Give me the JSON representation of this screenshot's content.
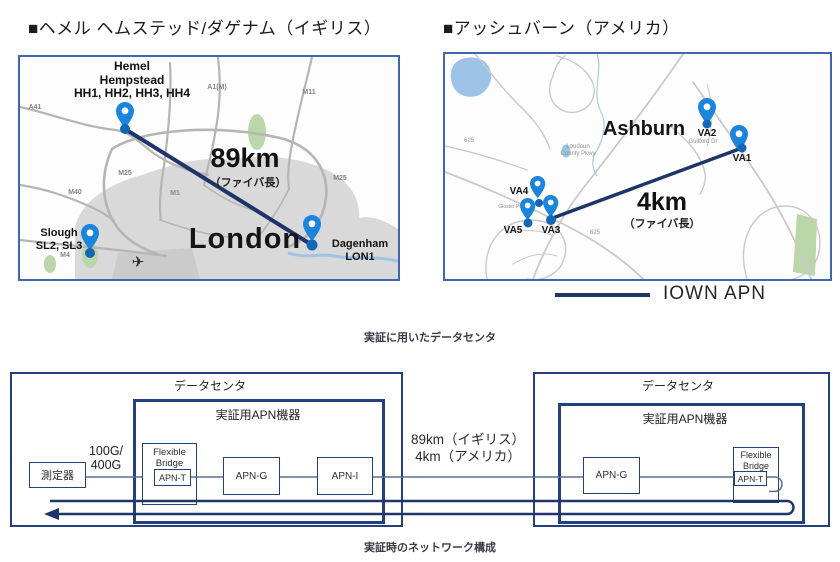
{
  "uk": {
    "title": "■ヘメル ヘムステッド/ダゲナム（イギリス）",
    "hemel": [
      "Hemel",
      "Hempstead",
      "HH1, HH2, HH3, HH4"
    ],
    "slough": [
      "Slough",
      "SL2, SL3"
    ],
    "dagenham": [
      "Dagenham",
      "LON1"
    ],
    "city": "London",
    "distance": "89km",
    "distance_note": "（ファイバ長）",
    "roads": {
      "a41": "A41",
      "a1m": "A1(M)",
      "m11": "M11",
      "m25": "M25",
      "m1": "M1",
      "m40": "M40",
      "m4": "M4"
    }
  },
  "us": {
    "title": "■アッシュバーン（アメリカ）",
    "city": "Ashburn",
    "pins": {
      "va1": "VA1",
      "va2": "VA2",
      "va3": "VA3",
      "va4": "VA4",
      "va5": "VA5"
    },
    "distance": "4km",
    "distance_note": "（ファイバ長）",
    "roads": {
      "loudoun": "Loudoun County Pkwy",
      "guilford": "Guilford Dr",
      "r625": "625",
      "gloster": "Gloster Pv"
    }
  },
  "legend": {
    "label": "IOWN APN"
  },
  "captions": {
    "maps": "実証に用いたデータセンタ",
    "network": "実証時のネットワーク構成"
  },
  "network": {
    "dc_label": "データセンタ",
    "apn_equipment_label": "実証用APN機器",
    "measure_label": "測定器",
    "rate": [
      "100G/",
      "400G"
    ],
    "flexible_bridge": [
      "Flexible",
      "Bridge"
    ],
    "apn_t": "APN-T",
    "apn_g": "APN-G",
    "apn_i": "APN-I",
    "fiber_label": [
      "89km（イギリス）",
      "4km（アメリカ）"
    ]
  },
  "icons": {
    "plane": "✈"
  },
  "colors": {
    "map_border": "#4266ad",
    "apn_line": "#1f3468",
    "pin_blue": "#1b84dd",
    "pin_dot": "#1467b5",
    "urban_gray": "#d9d9d9",
    "green_area": "#b9d7a8",
    "water_blue": "#9dc3e6",
    "diagram_border": "#24407e"
  }
}
